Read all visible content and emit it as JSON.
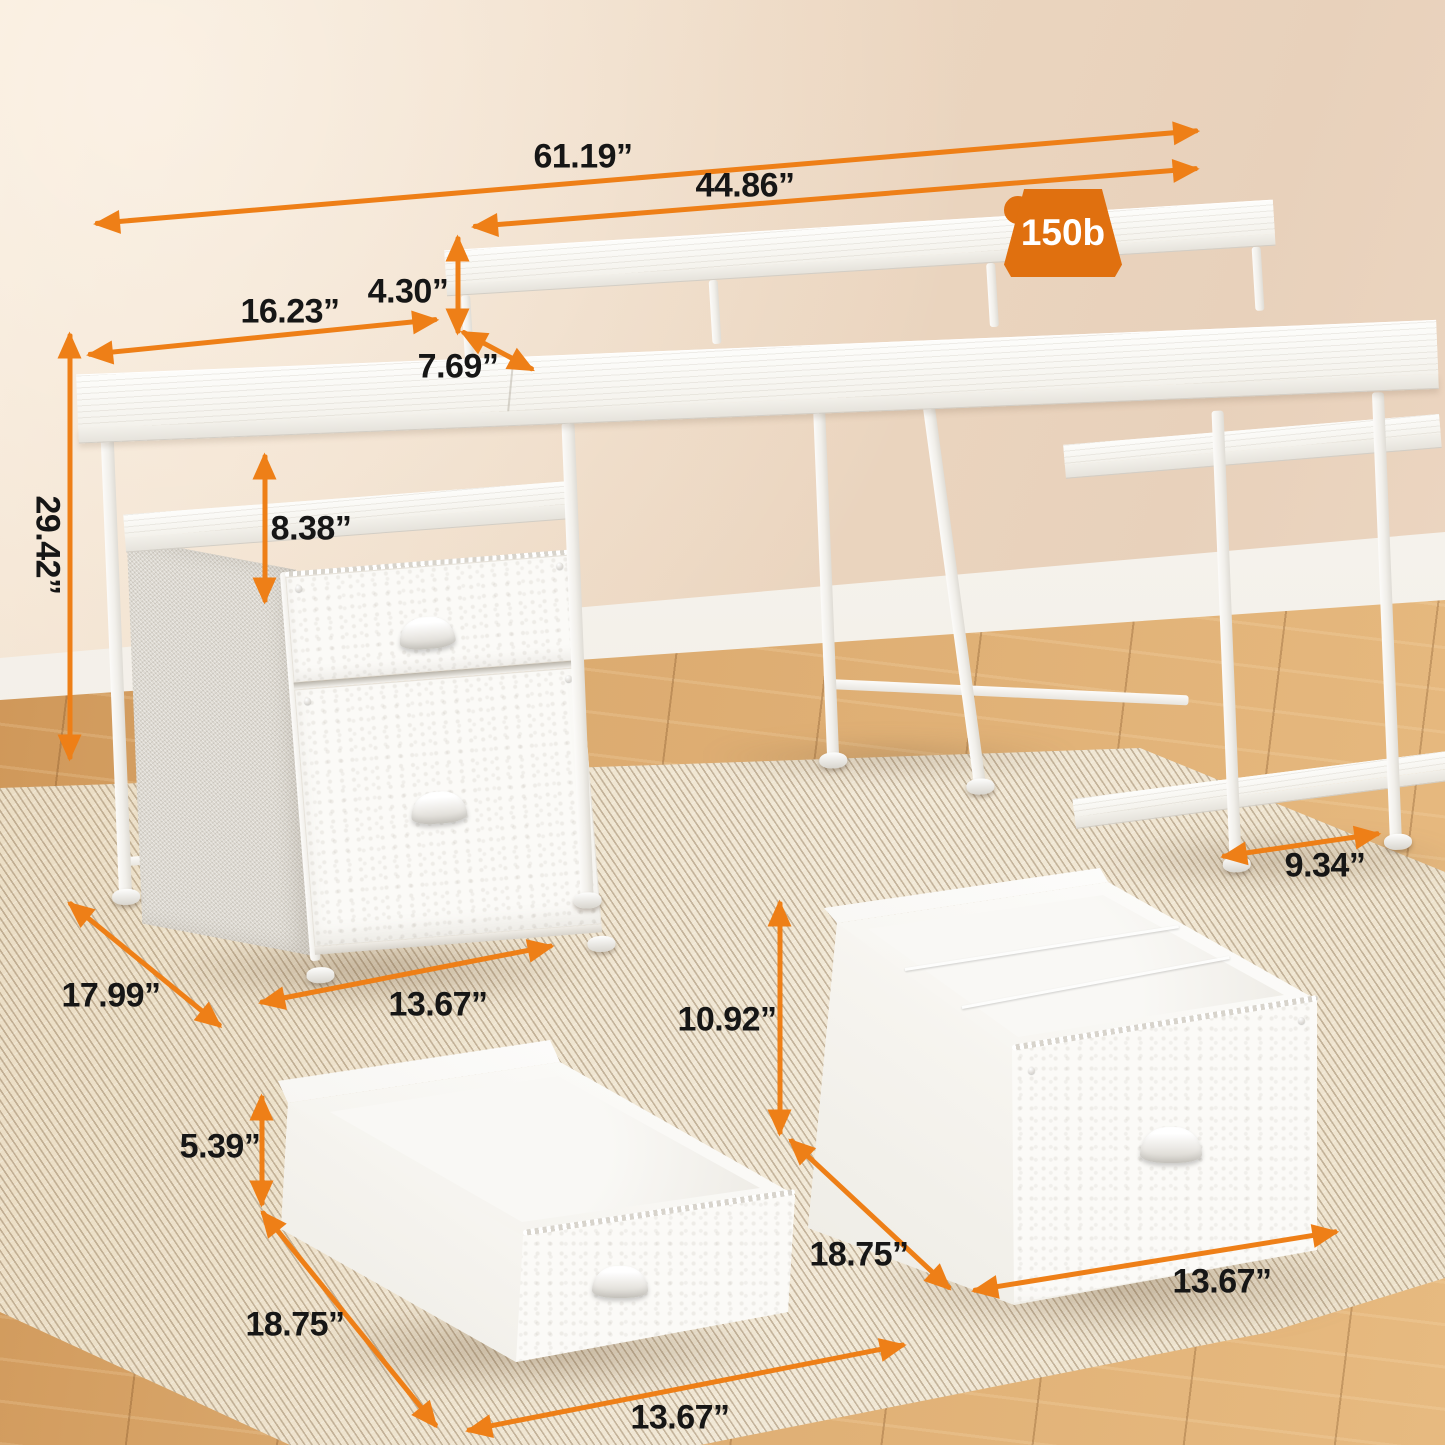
{
  "weight_badge": {
    "label": "150b"
  },
  "dimensions": {
    "overall_width": "61.19”",
    "monitor_shelf_width": "44.86”",
    "left_desktop_width": "16.23”",
    "monitor_shelf_height": "4.30”",
    "monitor_shelf_depth": "7.69”",
    "hutch_gap_height": "8.38”",
    "overall_height": "29.42”",
    "bottom_shelf_depth": "9.34”",
    "desk_depth": "17.99”",
    "pedestal_width": "13.67”",
    "file_drawer_height": "10.92”",
    "top_drawer_height": "5.39”",
    "top_drawer_depth": "18.75”",
    "top_drawer_width": "13.67”",
    "file_drawer_depth": "18.75”",
    "file_drawer_width": "13.67”"
  },
  "colors": {
    "arrow": "#ee7f17",
    "badge": "#e0700f",
    "label": "#161616"
  }
}
